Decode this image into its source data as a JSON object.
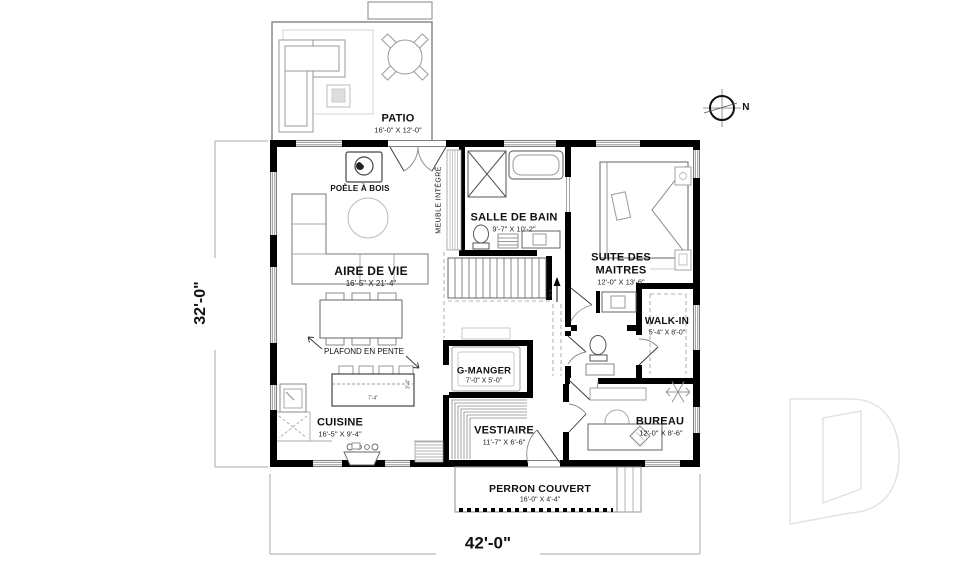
{
  "page": {
    "background": "#ffffff"
  },
  "compass": {
    "label": "N"
  },
  "dimensions": {
    "overall_width": "42'-0\"",
    "overall_height": "32'-0\""
  },
  "rooms": {
    "patio": {
      "name": "PATIO",
      "dims": "16'-0\" X 12'-0\""
    },
    "aire_de_vie": {
      "name": "AIRE DE VIE",
      "dims": "16'-5\" X 21'-4\""
    },
    "salle_de_bain": {
      "name": "SALLE DE BAIN",
      "dims": "9'-7\" X 10'-2\""
    },
    "suite_des_maitres": {
      "name_line1": "SUITE DES",
      "name_line2": "MAITRES",
      "dims": "12'-0\" X 13'-6\""
    },
    "walk_in": {
      "name": "WALK-IN",
      "dims": "5'-4\" X 8'-0\""
    },
    "g_manger": {
      "name": "G-MANGER",
      "dims": "7'-0\" X 5'-0\""
    },
    "cuisine": {
      "name": "CUISINE",
      "dims": "16'-5\" X 9'-4\""
    },
    "vestiaire": {
      "name": "VESTIAIRE",
      "dims": "11'-7\" X 6'-6\""
    },
    "bureau": {
      "name": "BUREAU",
      "dims": "12'-0\" X 8'-6\""
    },
    "perron_couvert": {
      "name": "PERRON COUVERT",
      "dims": "16'-0\" X 4'-4\""
    }
  },
  "annotations": {
    "poele_a_bois": "POÊLE À BOIS",
    "plafond_en_pente": "PLAFOND EN PENTE",
    "meuble_integre": "MEUBLE INTÉGRÉ",
    "island_width": "7'-4\"",
    "island_depth": "3'-4\"",
    "stair_direction": "S-S"
  },
  "colors": {
    "wall": "#000000",
    "fixture_line": "#666666",
    "light_line": "#aaaaaa",
    "watermark": "#e4e4e4"
  }
}
